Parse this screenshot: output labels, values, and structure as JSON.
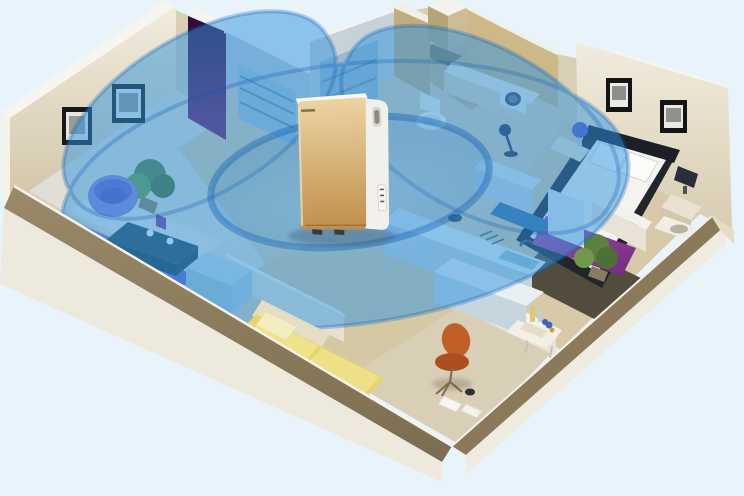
{
  "meta": {
    "title": "Air purifier whole-home coverage illustration",
    "scene_type": "isometric-apartment-cutaway"
  },
  "colors": {
    "background": "#e9f3fb",
    "floor_tan": "#d9cfb6",
    "carpet": "#e1ded7",
    "wall_cream_light": "#f2ecdd",
    "wall_cream_dark": "#d2c6aa",
    "wall_cap_white": "#f7f5ef",
    "wall_top_olive": "#9a8a6a",
    "wall_top_olive_dark": "#7c6d50",
    "outer_face": "#eee9dd",
    "bath_wall_beige": "#cdb888",
    "coverage_fill": "#2e93e0",
    "coverage_ring": "#0e5fb2",
    "coverage_glow": "#9fd4ff",
    "purifier_gold_light": "#ecd4a4",
    "purifier_gold_dark": "#c08f4A",
    "purifier_side": "#f2f0ea",
    "sofa_blue": "#6d79d4",
    "armchair_purple": "#8a80da",
    "coffee_table_teal": "#2c4b59",
    "cube_table_blue": "#c3dae4",
    "accent_panel_purple": "#7a1a64",
    "accent_panel_purple_deep": "#2f0b34",
    "bed_frame_dark": "#23252d",
    "mattress_white": "#f4f3ef",
    "bed_runner_purple": "#b14ba6",
    "bed_runner_purple_deep": "#6e2c80",
    "bedroom_rug_dark": "#514c3c",
    "guest_bed_yellow": "#e5d572",
    "guest_bed_yellow_light": "#f0e288",
    "chair_orange": "#c06028",
    "plant_green": "#5c8040",
    "kitchen_counter": "#e6eef2",
    "kitchen_cabinet": "#c2d3dd"
  },
  "scene": {
    "device": {
      "kind": "air-purifier",
      "panel_finish": "champagne-gold",
      "body_finish": "white",
      "brand_mark": "illegible small dark logotype",
      "position": "center of apartment"
    },
    "coverage": {
      "shape": "concentric translucent ellipses",
      "ring_count": 2,
      "meaning": "purification range radiating through rooms"
    },
    "rooms": [
      {
        "name": "living-room",
        "items": [
          "purple tub chair",
          "blue sofa",
          "teal coffee table with flowers",
          "cube side table",
          "corner plant",
          "two wall frames"
        ]
      },
      {
        "name": "wardrobe-closet",
        "items": [
          "purple accent panel",
          "shelving units"
        ]
      },
      {
        "name": "bathroom",
        "items": [
          "toilet",
          "counter",
          "washing machine"
        ]
      },
      {
        "name": "kitchen",
        "items": [
          "counter with sink and faucet",
          "pot",
          "dish rack",
          "lower counter",
          "fridge"
        ]
      },
      {
        "name": "master-bedroom",
        "items": [
          "double bed with purple runner",
          "two nightstand lamps",
          "dark rug",
          "plant",
          "wall frames"
        ]
      },
      {
        "name": "guest-bedroom",
        "items": [
          "yellow bed"
        ]
      },
      {
        "name": "hallway",
        "items": [
          "orange shell chair",
          "small table with bottles",
          "papers on floor"
        ]
      }
    ]
  }
}
